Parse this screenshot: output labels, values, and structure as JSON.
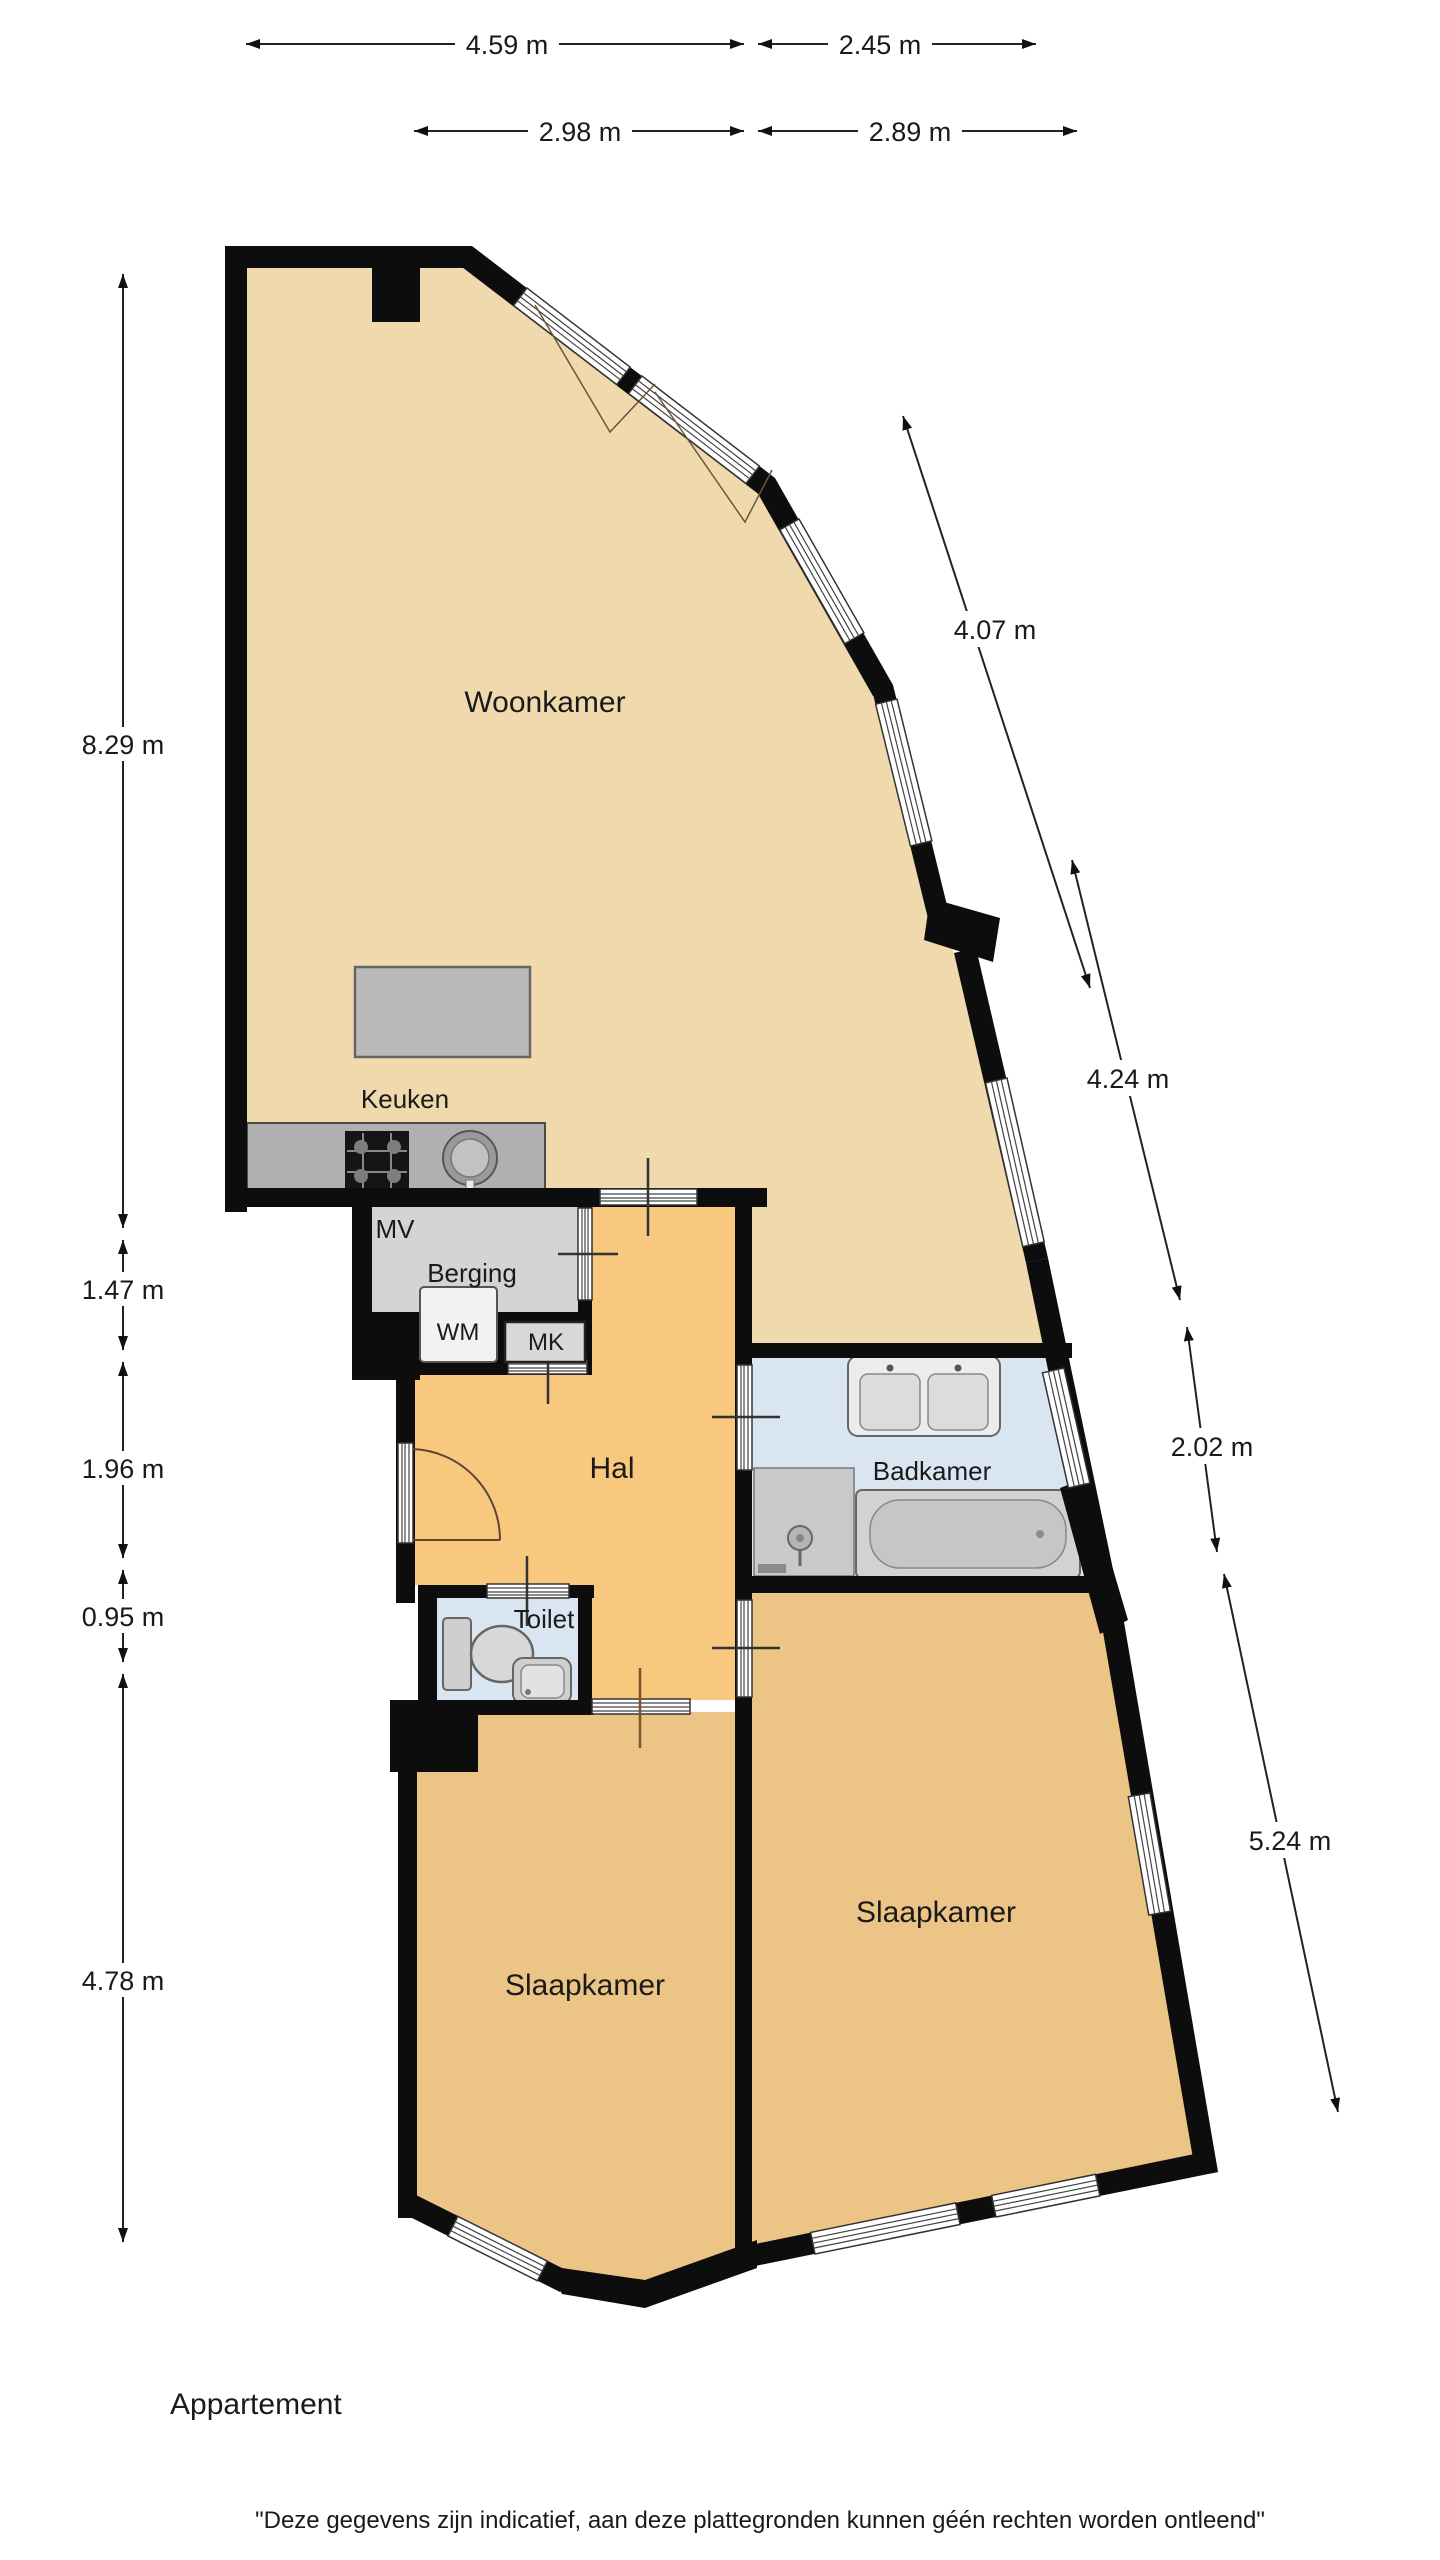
{
  "plan": {
    "title": "Appartement",
    "disclaimer": "\"Deze gegevens zijn indicatief, aan deze plattegronden kunnen géén rechten worden ontleend\"",
    "rooms": {
      "woonkamer": "Woonkamer",
      "keuken": "Keuken",
      "mv": "MV",
      "berging": "Berging",
      "wm": "WM",
      "mk": "MK",
      "hal": "Hal",
      "badkamer": "Badkamer",
      "toilet": "Toilet",
      "slaapkamer_left": "Slaapkamer",
      "slaapkamer_right": "Slaapkamer"
    },
    "dimensions": {
      "top_row1": [
        "4.59 m",
        "2.45 m"
      ],
      "top_row2": [
        "2.98 m",
        "2.89 m"
      ],
      "left": [
        "8.29 m",
        "1.47 m",
        "1.96 m",
        "0.95 m",
        "4.78 m"
      ],
      "right": [
        "4.07 m",
        "4.24 m",
        "2.02 m",
        "5.24 m"
      ]
    },
    "colors": {
      "wall": "#0d0d0d",
      "living_room_fill": "#f0d9ac",
      "hall_fill": "#f8c87e",
      "bedroom_fill": "#ecc486",
      "wet_room_fill": "#d9e6f2",
      "storage_fill": "#d4d4d4",
      "counter_fill": "#b0b0b0"
    }
  }
}
